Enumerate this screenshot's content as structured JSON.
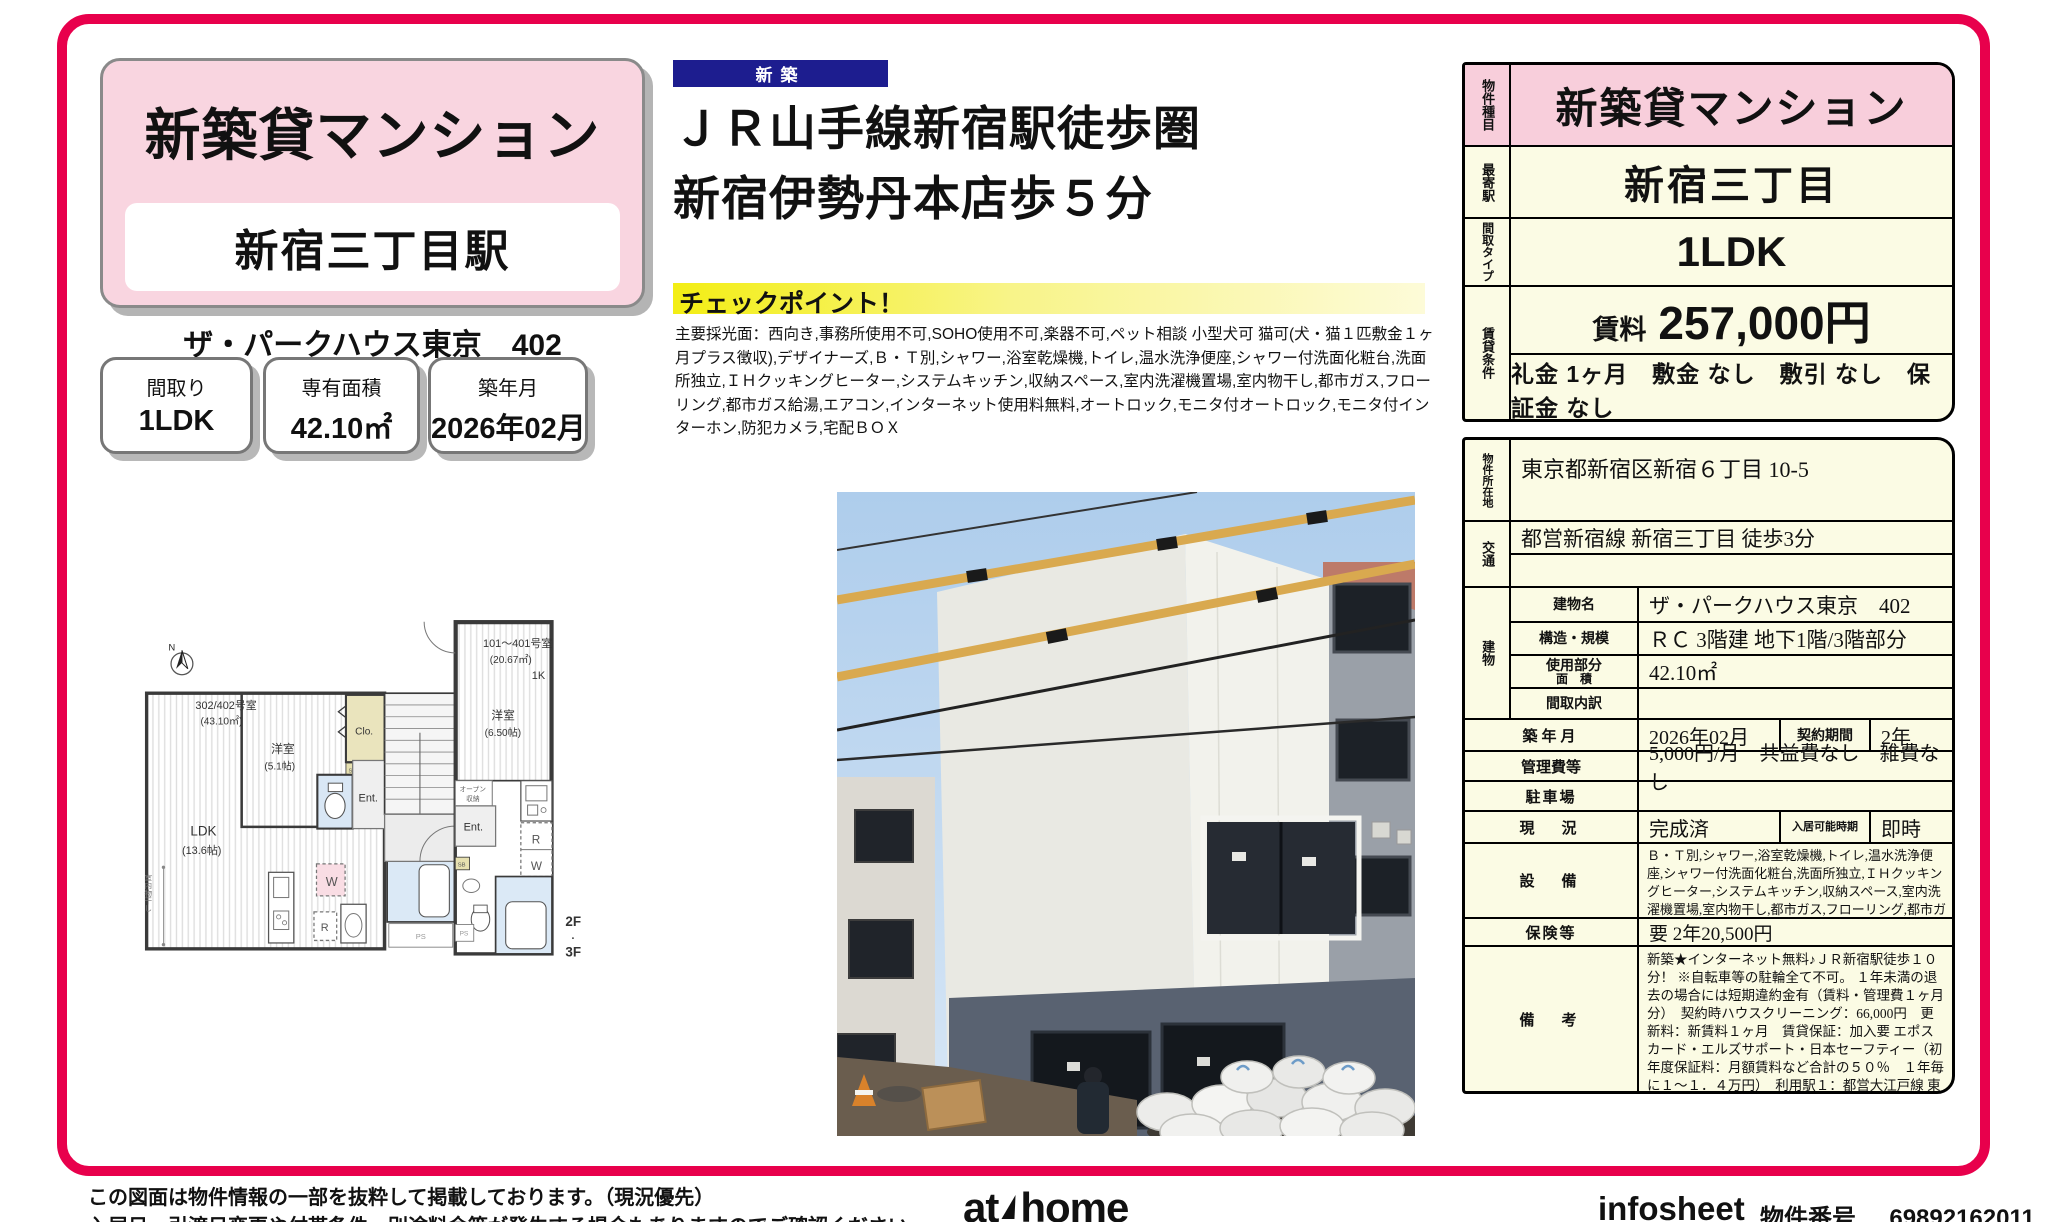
{
  "colors": {
    "accent": "#e8004c",
    "pink": "#f9d5e0",
    "table_pink": "#f8cedb",
    "cream": "#fbfbe4",
    "navy": "#1d1d8f",
    "checkpoint_yellow": "#f3ee14"
  },
  "header": {
    "title": "新築貸マンション",
    "station_box": "新宿三丁目駅",
    "building_line": "ザ・パークハウス東京　402",
    "facts": [
      {
        "label": "間取り",
        "value": "1LDK"
      },
      {
        "label": "専有面積",
        "value": "42.10㎡"
      },
      {
        "label": "築年月",
        "value": "2026年02月"
      }
    ]
  },
  "headline": {
    "badge": "新築",
    "line1": "ＪＲ山手線新宿駅徒歩圏",
    "line2": "新宿伊勢丹本店歩５分"
  },
  "checkpoint": {
    "title": "チェックポイント！",
    "body": "主要採光面：西向き,事務所使用不可,SOHO使用不可,楽器不可,ペット相談 小型犬可 猫可(犬・猫１匹敷金１ヶ月プラス徴収),デザイナーズ,Ｂ・Ｔ別,シャワー,浴室乾燥機,トイレ,温水洗浄便座,シャワー付洗面化粧台,洗面所独立,ＩＨクッキングヒーター,システムキッチン,収納スペース,室内洗濯機置場,室内物干し,都市ガス,フローリング,都市ガス給湯,エアコン,インターネット使用料無料,オートロック,モニタ付オートロック,モニタ付インターホン,防犯カメラ,宅配ＢＯＸ"
  },
  "floorplan": {
    "compass": "N",
    "unit_left_name": "302/402号室",
    "unit_left_area": "(43.10㎡)",
    "room_west": "洋室",
    "room_west_size": "(5.1帖)",
    "closet": "Clo.",
    "sb1": "SB",
    "ent_left": "Ent.",
    "ldk": "LDK",
    "ldk_size": "(13.6帖)",
    "w1": "W",
    "r1": "R",
    "ps1": "PS",
    "unit_right_name": "101～401号室",
    "unit_right_area": "(20.67㎡)",
    "unit_right_type": "1K",
    "room_right": "洋室",
    "room_right_size": "(6.50帖)",
    "open_storage_1": "オープン",
    "open_storage_2": "収納",
    "ent_right": "Ent.",
    "r2": "R",
    "w2": "W",
    "sb2": "SB",
    "ps2": "PS",
    "indoor_drying": "室内物干し",
    "floor_note_1": "2F",
    "floor_note_dot": "・",
    "floor_note_2": "3F"
  },
  "spec_table": {
    "type_label": "物件種目",
    "type_value": "新築貸マンション",
    "station_label": "最寄駅",
    "station_value": "新宿三丁目",
    "layout_label": "間取タイプ",
    "layout_value": "1LDK",
    "terms_label": "賃貸条件",
    "rent_label": "賃料",
    "rent_value": "257,000円",
    "terms_value": "礼金 1ヶ月　敷金 なし　敷引 なし　保証金 なし"
  },
  "detail_table": {
    "address_label": "物件所在地",
    "address_value": "東京都新宿区新宿６丁目 10-5",
    "access_label": "交通",
    "access_value": "都営新宿線 新宿三丁目 徒歩3分",
    "building_label": "建物",
    "building_name_label": "建物名",
    "building_name_value": "ザ・パークハウス東京　402",
    "structure_label": "構造・規模",
    "structure_value": "ＲＣ 3階建 地下1階/3階部分",
    "area_label_1": "使用部分",
    "area_label_2": "面　積",
    "area_value": "42.10㎡",
    "layout_detail_label": "間取内訳",
    "layout_detail_value": "",
    "built_label": "築年月",
    "built_value": "2026年02月",
    "contract_label": "契約期間",
    "contract_value": "2年",
    "fees_label": "管理費等",
    "fees_value": "5,000円/月　共益費なし　雑費なし",
    "parking_label": "駐車場",
    "parking_value": "",
    "status_label": "現　況",
    "status_value": "完成済",
    "movein_label": "入居可能時期",
    "movein_value": "即時",
    "equipment_label": "設　備",
    "equipment_value": "Ｂ・Ｔ別,シャワー,浴室乾燥機,トイレ,温水洗浄便座,シャワー付洗面化粧台,洗面所独立,ＩＨクッキングヒーター,システムキッチン,収納スペース,室内洗濯機置場,室内物干し,都市ガス,フローリング,都市ガス給湯,エアコン,インターネット使用料無料,オートロック,モニタ付オートロック,モニ...",
    "insurance_label": "保険等",
    "insurance_value": "要 2年20,500円",
    "notes_label": "備　考",
    "notes_value": "新築★インターネット無料♪ＪＲ新宿駅徒歩１０分！ ※自転車等の駐輪全て不可。 １年未満の退去の場合には短期違約金有（賃料・管理費１ヶ月分）　契約時ハウスクリーニング：66,000円　更新料：新賃料１ヶ月　賃貸保証：加入要 エポスカード・エルズサポート・日本セーフティー（初年度保証料：月額賃料など合計の５０％　１年毎に１～１．４万円）　利用駅１：都営大江戸線 東新宿 徒歩7分　利用駅２：ＪＲ中央本線 新宿 徒歩10分"
  },
  "footer": {
    "disclaimer1": "この図面は物件情報の一部を抜粋して掲載しております。（現況優先）",
    "disclaimer2": "入居日・引渡日変更や付帯条件、別途料金等が発生する場合もありますのでご確認ください。",
    "logo_at": "at",
    "logo_home": "home",
    "infosheet": "infosheet",
    "property_no_label": "物件番号",
    "property_no": "69892162011"
  }
}
